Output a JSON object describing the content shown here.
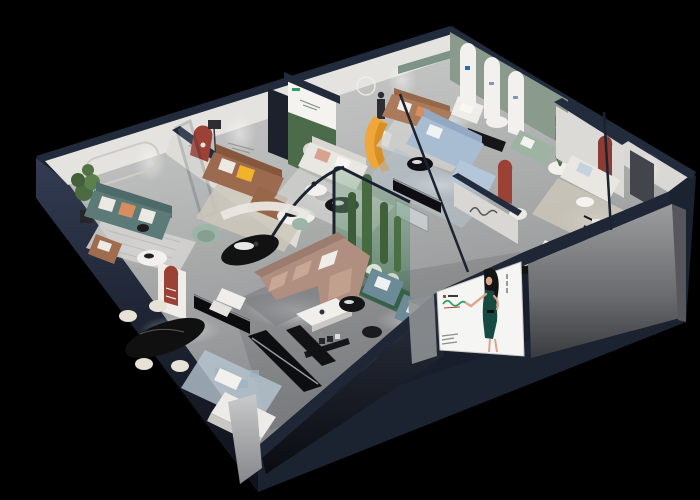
{
  "meta": {
    "description": "3D isometric cutaway render of a furniture showroom floor plan on a black background",
    "style": "dollhouse cutaway, spotlit interiors, dark navy wall caps"
  },
  "palette": {
    "background": "#000000",
    "wall_cap_navy": "#222b3c",
    "exterior_navy_top": "#323b52",
    "exterior_navy_bottom": "#10131c",
    "wall_face": "#e4e3df",
    "green_wall": "#8a9a8c",
    "floor_light": "#c6c7c5",
    "floor_dark": "#8f9293",
    "poster_forest": "#4c6b4a",
    "terrarium_green": "#5e8a6a",
    "sofa_teal": "#5c7a78",
    "sofa_brown": "#9c6a4e",
    "sofa_tan": "#ab7a5a",
    "sofa_white": "#e9e7e2",
    "sofa_mauve": "#b18f80",
    "sofa_lightblue": "#a9bdd2",
    "sofa_sage": "#9eb3a2",
    "sofa_slateblue": "#6d8a97",
    "bench_teal": "#7fa3ab",
    "accent_orange": "#efa63a",
    "pillow_yellow": "#f0b32c",
    "accent_red_arch": "#9c4136",
    "accent_red_bright": "#c03a30",
    "plant_green": "#4c6b42",
    "rug_light": "#d3d2cf",
    "rug_beige": "#cec8bb",
    "rug_blue": "#b6c6d1",
    "table_black": "#121212",
    "billboard_white": "#f5f5f3",
    "brand_green": "#2f9e63",
    "model_dress_green": "#174a40",
    "model_skin": "#d8a78c",
    "model_hair": "#141414"
  },
  "scene": {
    "rooms": [
      {
        "name": "lounge-teal",
        "furniture": [
          "stadium wall moulding",
          "tall plant",
          "teal three-seat sofa",
          "striped rug",
          "round white coffee table",
          "brown armchair"
        ]
      },
      {
        "name": "lounge-brown-leather",
        "furniture": [
          "red arched niche",
          "glass door panel",
          "brown leather sofa with yellow pillow",
          "beige rug",
          "white oval coffee table",
          "floor lamp"
        ]
      },
      {
        "name": "gallery-forest-poster",
        "furniture": [
          "forest artwork poster wall",
          "white fabric sofa",
          "orange sculptural bench",
          "mannequin on plinth",
          "ring lamp",
          "round black coffee table"
        ]
      },
      {
        "name": "apex-tan-lounge",
        "furniture": [
          "recessed green wall sign",
          "tan leather sofa",
          "white armchair",
          "round side table",
          "grey rug"
        ]
      },
      {
        "name": "arch-display-wall",
        "furniture": [
          "sage green wall",
          "three white arched panels"
        ]
      },
      {
        "name": "lounge-light-blue",
        "furniture": [
          "light blue sofa with chaise",
          "blue rug",
          "black coffee table",
          "sage loveseat",
          "round table with plant",
          "red arched column",
          "white chair"
        ]
      },
      {
        "name": "lounge-white-right",
        "furniture": [
          "red framed mini prints",
          "red arched niche",
          "dark wardrobe panel",
          "white sofas",
          "beige rug",
          "black wall shelf",
          "black round table",
          "teal bench",
          "white chaise"
        ]
      },
      {
        "name": "center-atrium",
        "furniture": [
          "glass cactus terrarium",
          "mauve sectional sofa",
          "white coffee table",
          "black oval table",
          "curved white partition",
          "mint armchair"
        ]
      },
      {
        "name": "center-lounge-slate",
        "furniture": [
          "two slate-blue armchairs",
          "black side tables",
          "grey ottoman",
          "teal ottoman",
          "wall shelf with glyph sign"
        ]
      },
      {
        "name": "dining-front-left",
        "furniture": [
          "red arched shelf unit",
          "black sideboard",
          "black oval dining table",
          "four cream chairs",
          "blue pixel rug",
          "white lounge bed",
          "black display benches",
          "white nesting tables"
        ]
      }
    ],
    "billboard": {
      "position": "front cut face, right of center",
      "content": "fashion model with long black hair in dark green halter dress gesturing left, green script brand mark, fine print lines",
      "board_color": "#f5f5f3"
    },
    "lighting": {
      "spotlights_on_floor": 10,
      "wall_washes": 7,
      "ambient": "black void"
    }
  }
}
